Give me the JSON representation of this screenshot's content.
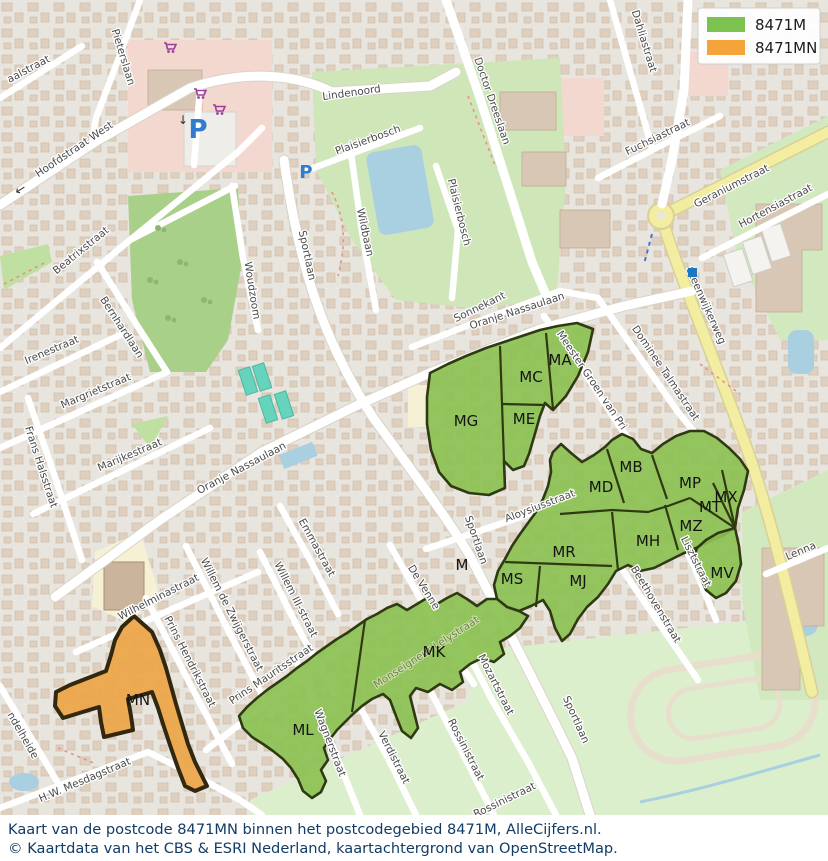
{
  "legend": {
    "items": [
      {
        "label": "8471M",
        "color": "#7cc24e"
      },
      {
        "label": "8471MN",
        "color": "#f5a43c"
      }
    ]
  },
  "caption": {
    "line1": "Kaart van de postcode 8471MN binnen het postcodegebied 8471M, AlleCijfers.nl.",
    "line2": "© Kaartdata van het CBS & ESRI Nederland, kaartachtergrond van OpenStreetMap."
  },
  "map": {
    "colors": {
      "region_green": "#8bc152",
      "region_green_border": "#2f3a12",
      "region_orange": "#eca74b",
      "region_orange_border": "#32270f"
    },
    "icons": {
      "parking": "P",
      "arrow_left": "←",
      "arrow_down": "↓"
    },
    "region_labels": [
      "MA",
      "MC",
      "ME",
      "MG",
      "MB",
      "MD",
      "MP",
      "MX",
      "MT",
      "MZ",
      "MH",
      "MR",
      "MS",
      "MJ",
      "MV",
      "MK",
      "ML",
      "MN",
      "M"
    ],
    "street_labels": [
      "aalstraat",
      "Pieterslaan",
      "Hoofdstraat West",
      "Lindenoord",
      "Plaisierbosch",
      "Plaisierbosch",
      "Wildbaan",
      "Sportlaan",
      "Woudzoom",
      "Doctor Dreeslaan",
      "Dahliastraat",
      "Fuchsiastraat",
      "Geraniumstraat",
      "Hortensiastraat",
      "Steenwijkerweg",
      "Sonnekant",
      "Oranje Nassaulaan",
      "Oranje Nassaulaan",
      "Beatrixstraat",
      "Bernhardlaan",
      "Irenestraat",
      "Margrietstraat",
      "Marijkestraat",
      "Frans Halsstraat",
      "Dominee Talmastraat",
      "Meester Groen van Pri",
      "Aloysiusstraat",
      "Sportlaan",
      "De Venne",
      "Emmastraat",
      "Willem III-straat",
      "Willem de Zwijgerstraat",
      "Prins Hendrikstraat",
      "Prins Mauritsstraat",
      "Wilhelminastraat",
      "H.W. Mesdagstraat",
      "ndelheide",
      "Wagnerstraat",
      "Verdistraat",
      "Rossinistraat",
      "Rossinistraat",
      "Mozartstraat",
      "Sportlaan",
      "Beethovenstraat",
      "Lisztstraat",
      "Lenna",
      "Monseigneur Lelystraat"
    ]
  }
}
